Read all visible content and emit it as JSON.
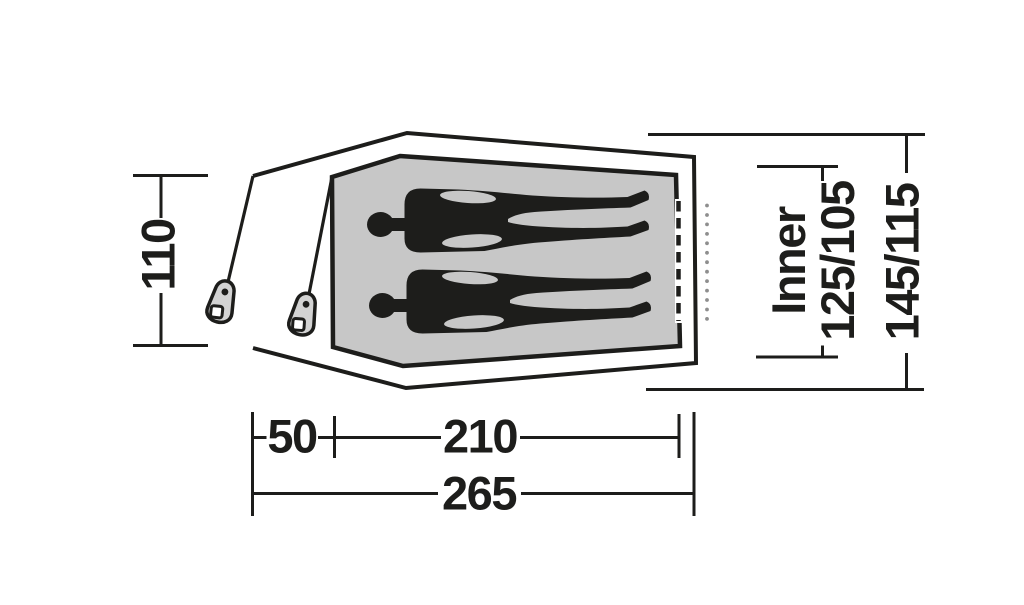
{
  "diagram": {
    "subject": "tent floor plan top view with two sleepers",
    "dimensions": {
      "porch_height": "110",
      "porch_depth": "50",
      "inner_length": "210",
      "total_length": "265",
      "inner_word": "Inner",
      "inner_widths": "125/105",
      "outer_widths": "145/115"
    },
    "colors": {
      "line": "#1d1d1b",
      "inner_floor_fill": "#c7c7c7",
      "tensioner_fill": "#d3d3d3",
      "dotted_line": "#8e8e8e",
      "background": "#ffffff"
    }
  }
}
